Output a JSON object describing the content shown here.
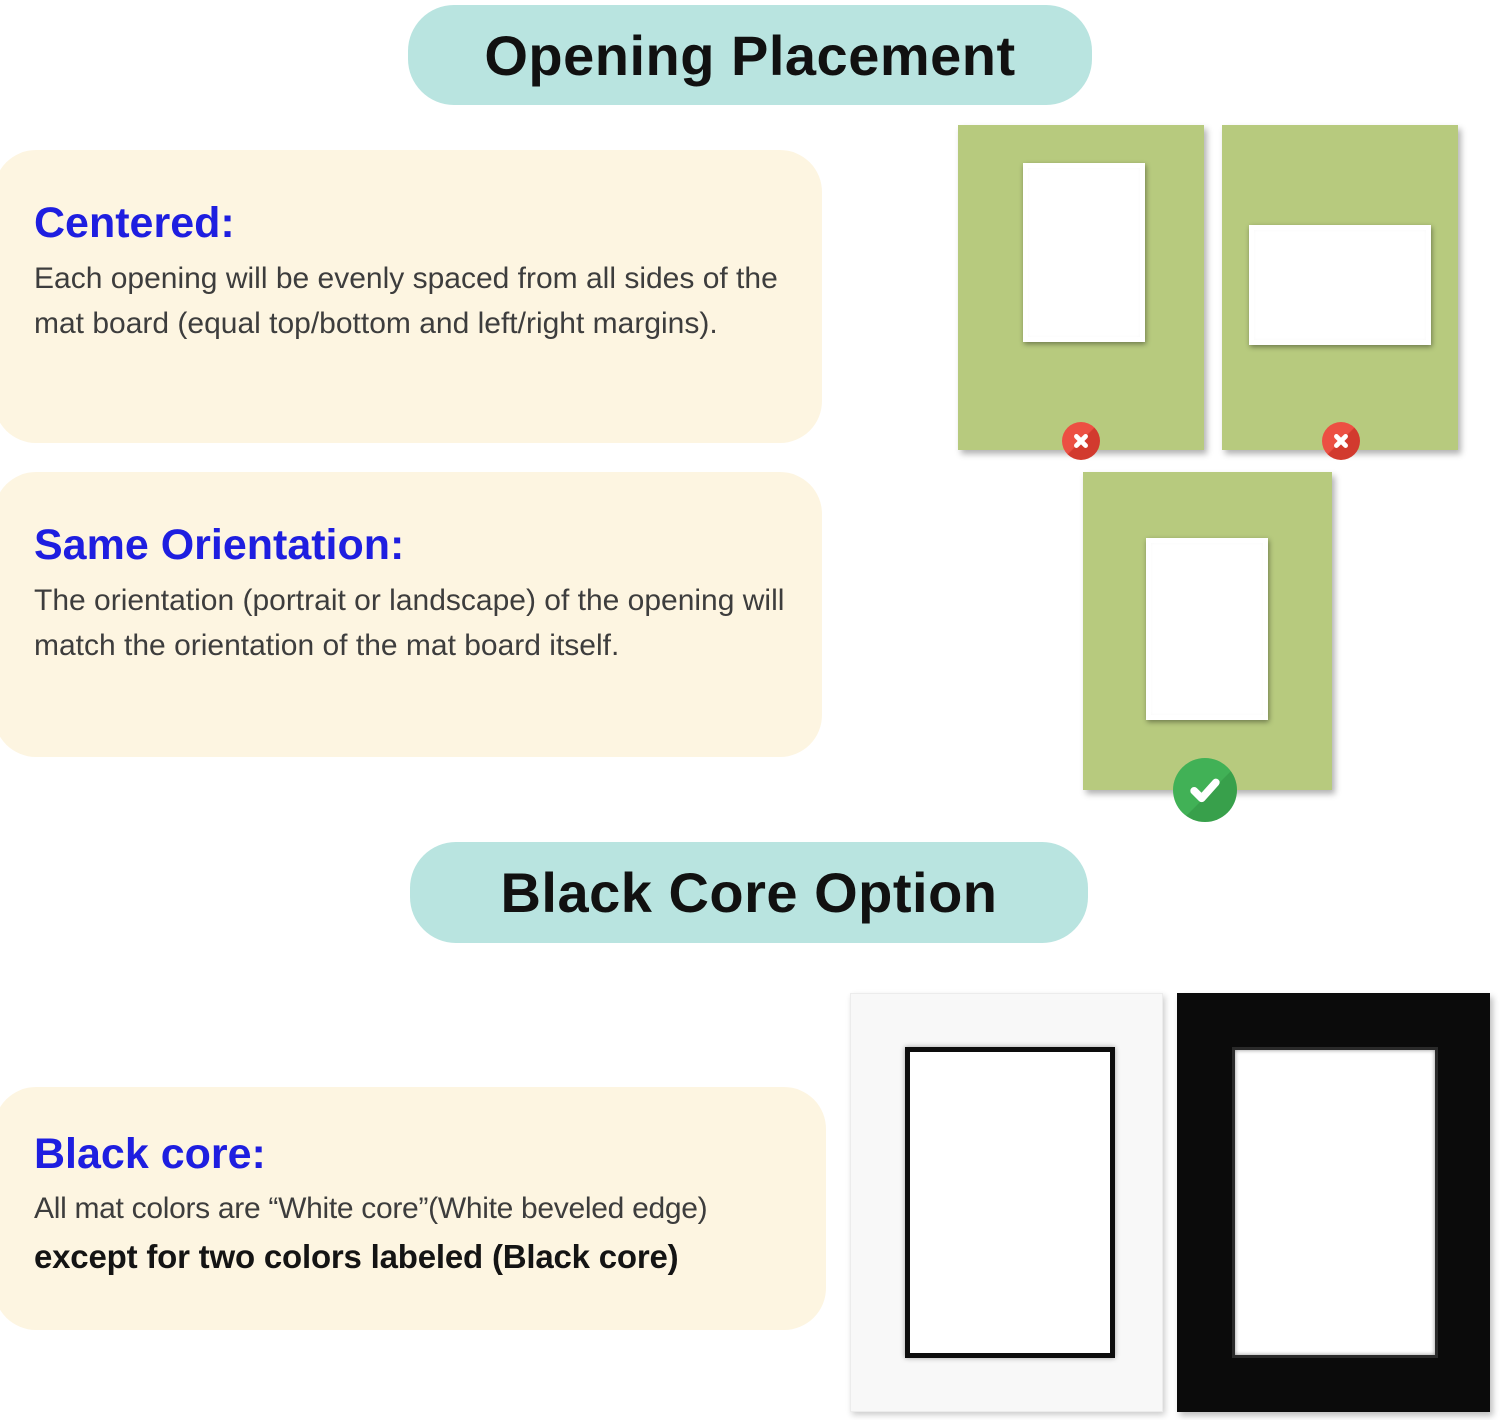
{
  "colors": {
    "header_pill_bg": "#b9e4e0",
    "pill_text": "#111111",
    "panel_bg": "#fdf5e1",
    "heading_blue": "#1e1ee0",
    "body_text": "#3d3d3d",
    "mat_green": "#b7ca7e",
    "mat_white": "#f8f8f8",
    "mat_black": "#0b0b0b",
    "error_red": "#ec5043",
    "error_red_shadow": "#d23a2e",
    "success_green": "#41b156",
    "success_green_shadow": "#38a04b"
  },
  "section_opening_placement": {
    "header": "Opening Placement",
    "panels": [
      {
        "heading": "Centered:",
        "body": "Each opening will be evenly spaced from all sides of the mat board (equal top/bottom and left/right margins)."
      },
      {
        "heading": "Same Orientation:",
        "body": "The orientation (portrait or landscape) of the opening will match the orientation of the mat board itself."
      }
    ],
    "examples": [
      {
        "name": "off-center-opening",
        "status": "wrong"
      },
      {
        "name": "landscape-opening-in-portrait-mat",
        "status": "wrong"
      },
      {
        "name": "centered-same-orientation-opening",
        "status": "correct"
      }
    ]
  },
  "section_black_core": {
    "header": "Black Core Option",
    "panel": {
      "heading": "Black core:",
      "body_line1": "All mat colors are “White core”(White beveled edge)",
      "body_line2_bold": "except for two colors labeled (Black core)"
    },
    "examples": [
      {
        "name": "white-mat-with-black-core"
      },
      {
        "name": "black-mat-with-black-core"
      }
    ]
  }
}
